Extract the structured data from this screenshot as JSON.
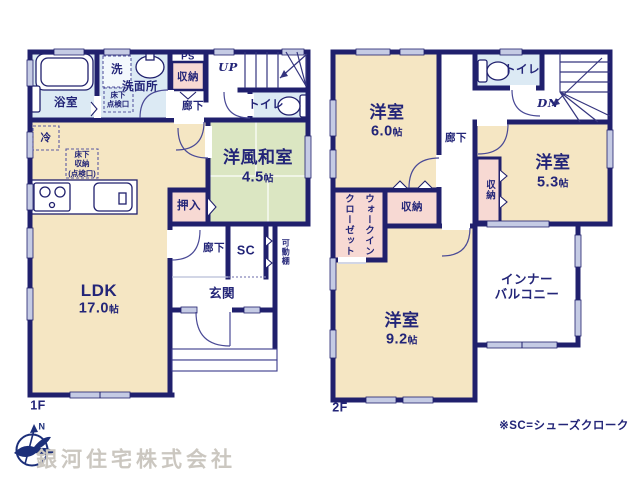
{
  "palette": {
    "wall": "#20206d",
    "room_tan": "#f5e6c3",
    "room_blue": "#dceaf4",
    "room_green": "#dbe6c2",
    "room_pink": "#f7d9d3",
    "label_text": "#232578",
    "window_fill": "#c5cbe4",
    "logo_navy": "#1c2f7a",
    "company_gray": "#cbc7c0"
  },
  "tatami_unit": "帖",
  "floor_1f": {
    "floor_label": "1F",
    "bath_label": "浴室",
    "washroom_label": "洗面所",
    "washer_label": "洗",
    "underfloor_hatch_label": "床下\n点検口",
    "ps_label": "PS",
    "storage_label": "収納",
    "hallway_upper_label": "廊下",
    "stairs_label": "UP",
    "toilet_label": "トイレ",
    "fridge_label": "冷",
    "underfloor_storage_label": "床下\n収納\n(点検口)",
    "ldk_label": "LDK",
    "ldk_size": "17.0",
    "washitsu_label": "洋風和室",
    "washitsu_size": "4.5",
    "oshiire_label": "押入",
    "hallway_lower_label": "廊下",
    "sc_label": "SC",
    "shelf_label": "可動棚",
    "entrance_label": "玄関"
  },
  "floor_2f": {
    "floor_label": "2F",
    "room1_label": "洋室",
    "room1_size": "6.0",
    "hallway_label": "廊下",
    "toilet_label": "トイレ",
    "stairs_label": "DN",
    "room2_label": "洋室",
    "room2_size": "5.3",
    "closet_vert_label": "収納",
    "wic_line1": "ウォークイン",
    "wic_line2": "クローゼット",
    "storage_label": "収納",
    "room3_label": "洋室",
    "room3_size": "9.2",
    "balcony_label": "インナー\nバルコニー"
  },
  "footer": {
    "note": "※SC=シューズクローク",
    "company": "銀河住宅株式会社",
    "compass_label": "N"
  }
}
